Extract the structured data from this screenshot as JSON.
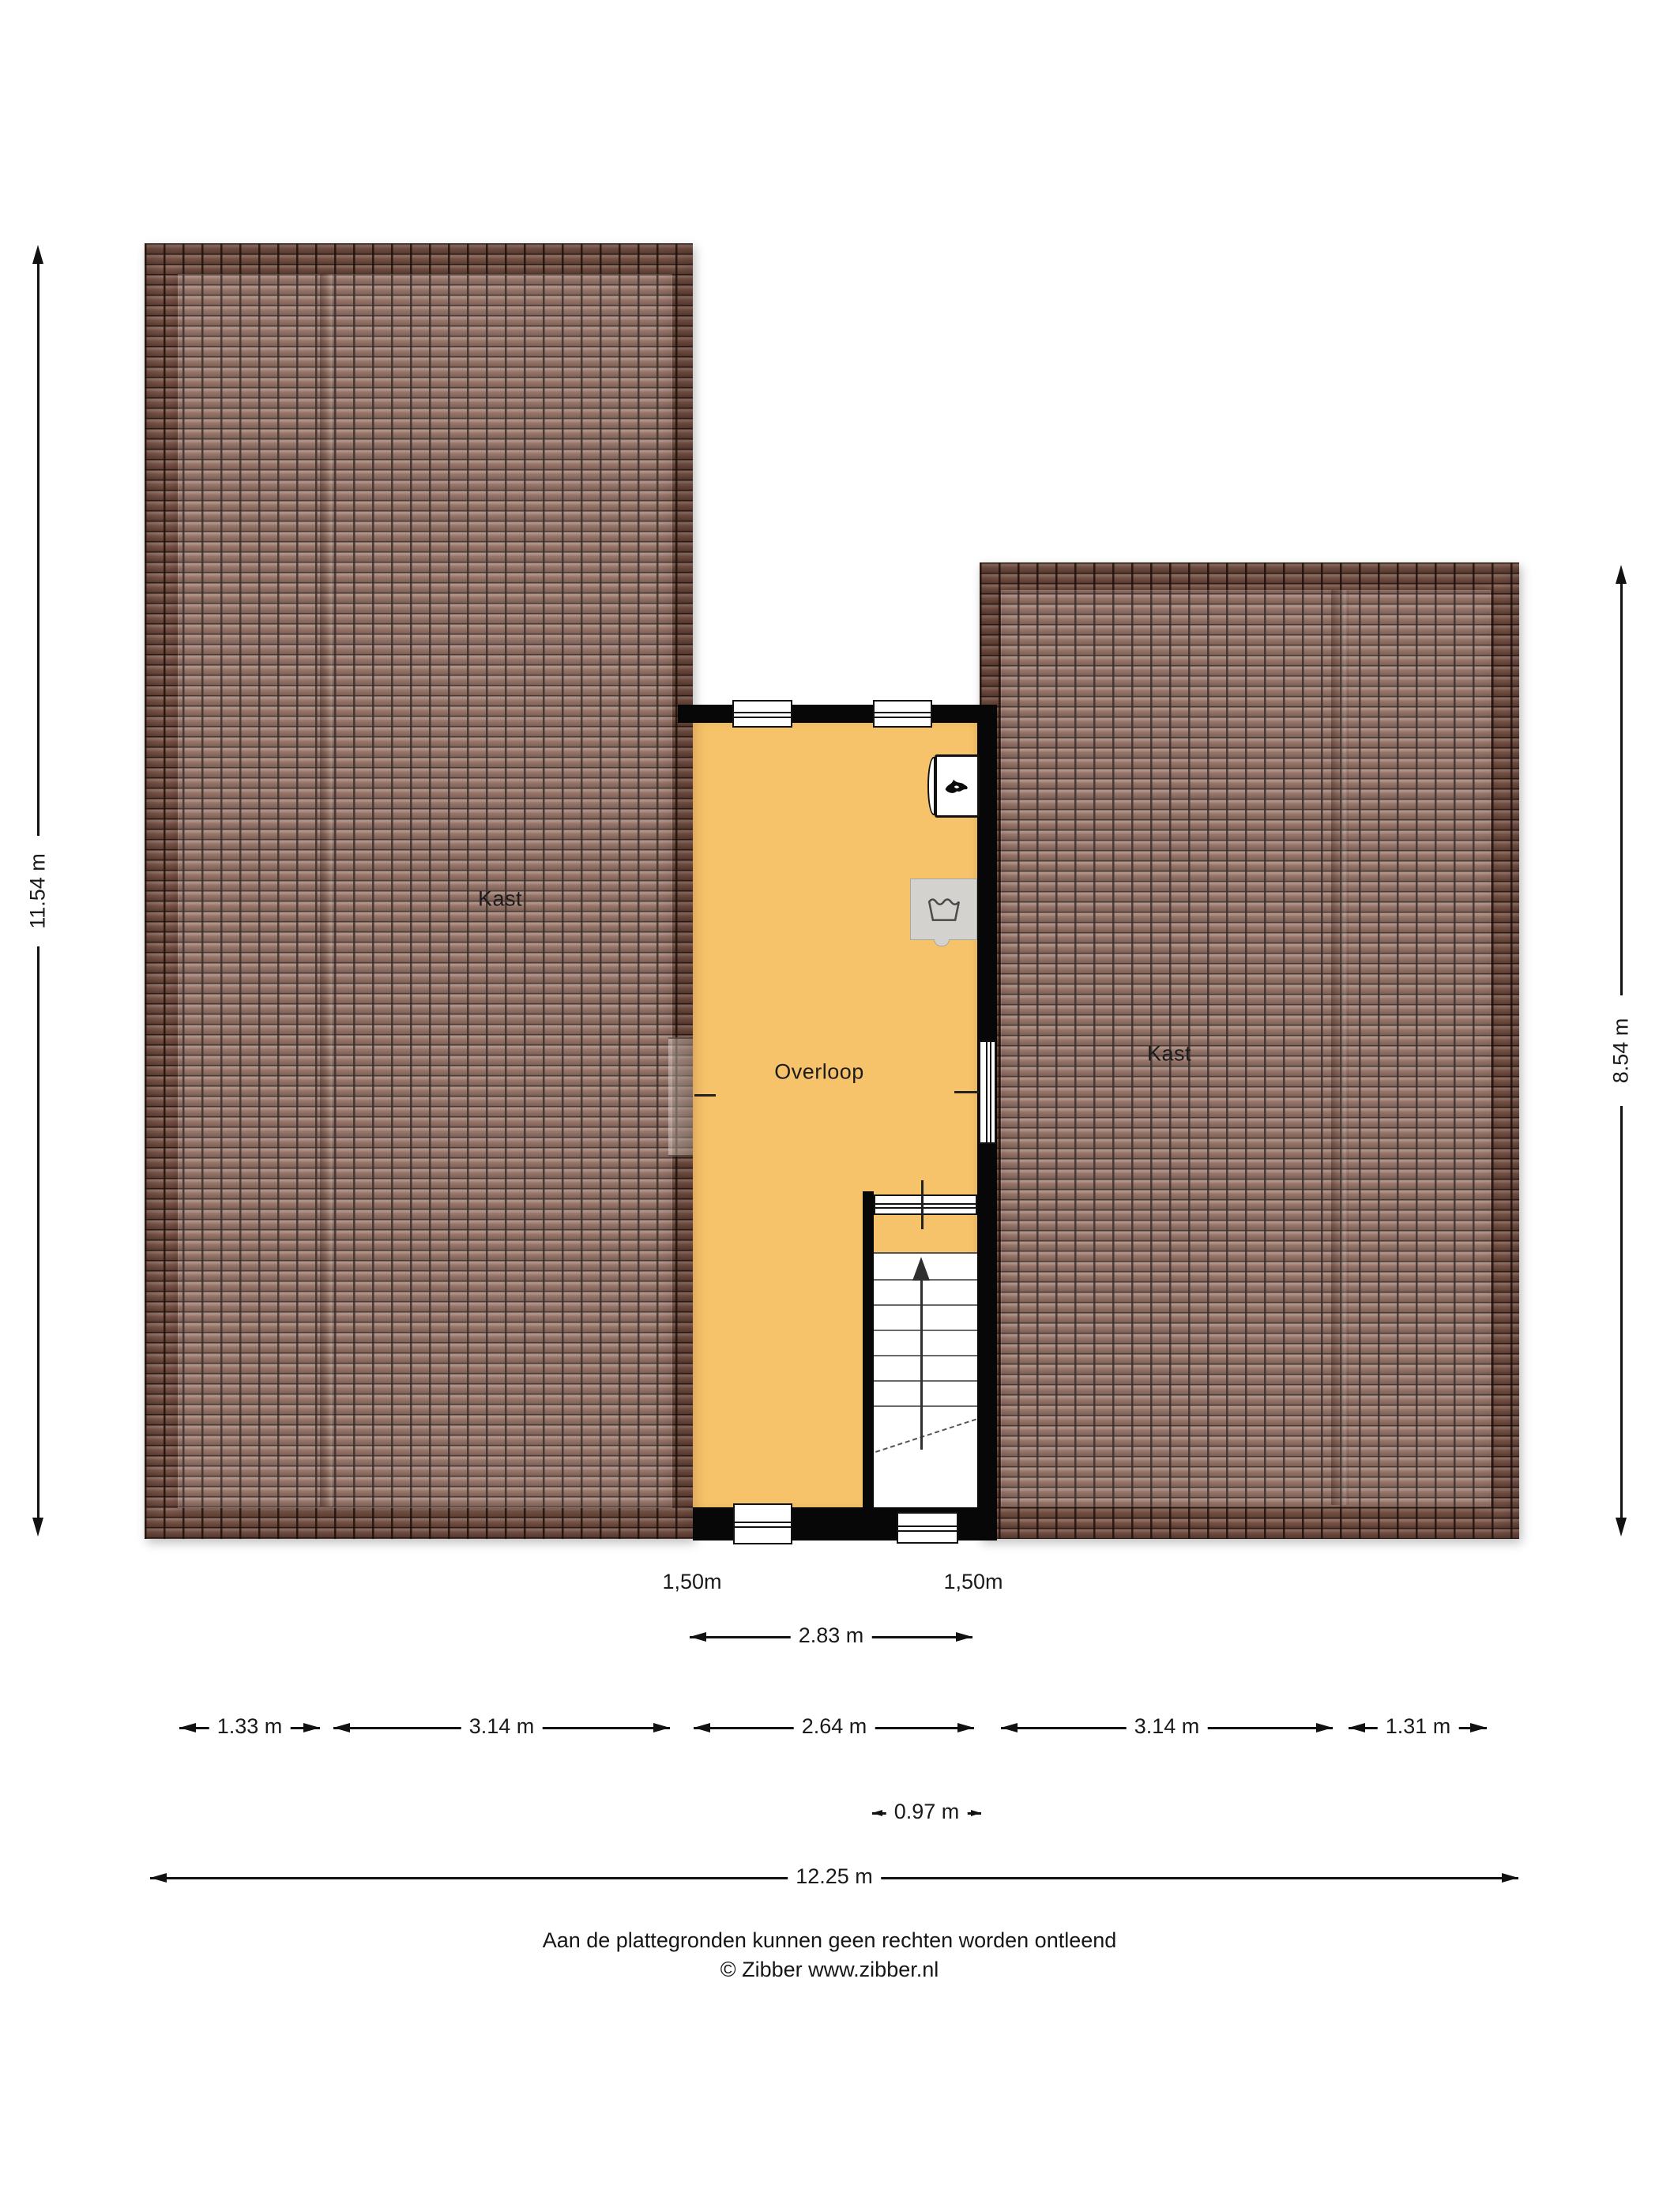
{
  "rooms": {
    "left_closet": {
      "label": "Kast"
    },
    "right_closet": {
      "label": "Kast"
    },
    "landing": {
      "label": "Overloop"
    }
  },
  "icons": {
    "ventilation": "flame-icon",
    "laundry": "wash-tub-icon",
    "stairs": "arrow-up-icon"
  },
  "dimensions": {
    "left_height": "11.54 m",
    "right_height": "8.54 m",
    "left_window_width": "1,50m",
    "right_window_width": "1,50m",
    "landing_span": "2.83 m",
    "bottom_row": [
      "1.33 m",
      "3.14 m",
      "2.64 m",
      "3.14 m",
      "1.31 m"
    ],
    "stair_width": "0.97 m",
    "total_width": "12.25 m"
  },
  "footer": {
    "disclaimer": "Aan de plattegronden kunnen geen rechten worden ontleend",
    "copyright": "© Zibber www.zibber.nl"
  },
  "colors": {
    "floor": "#F6C36B",
    "roof_tile": "#8A6153",
    "roof_grout": "#301E17",
    "wall": "#070707",
    "appliance": "#D4D2CF"
  }
}
